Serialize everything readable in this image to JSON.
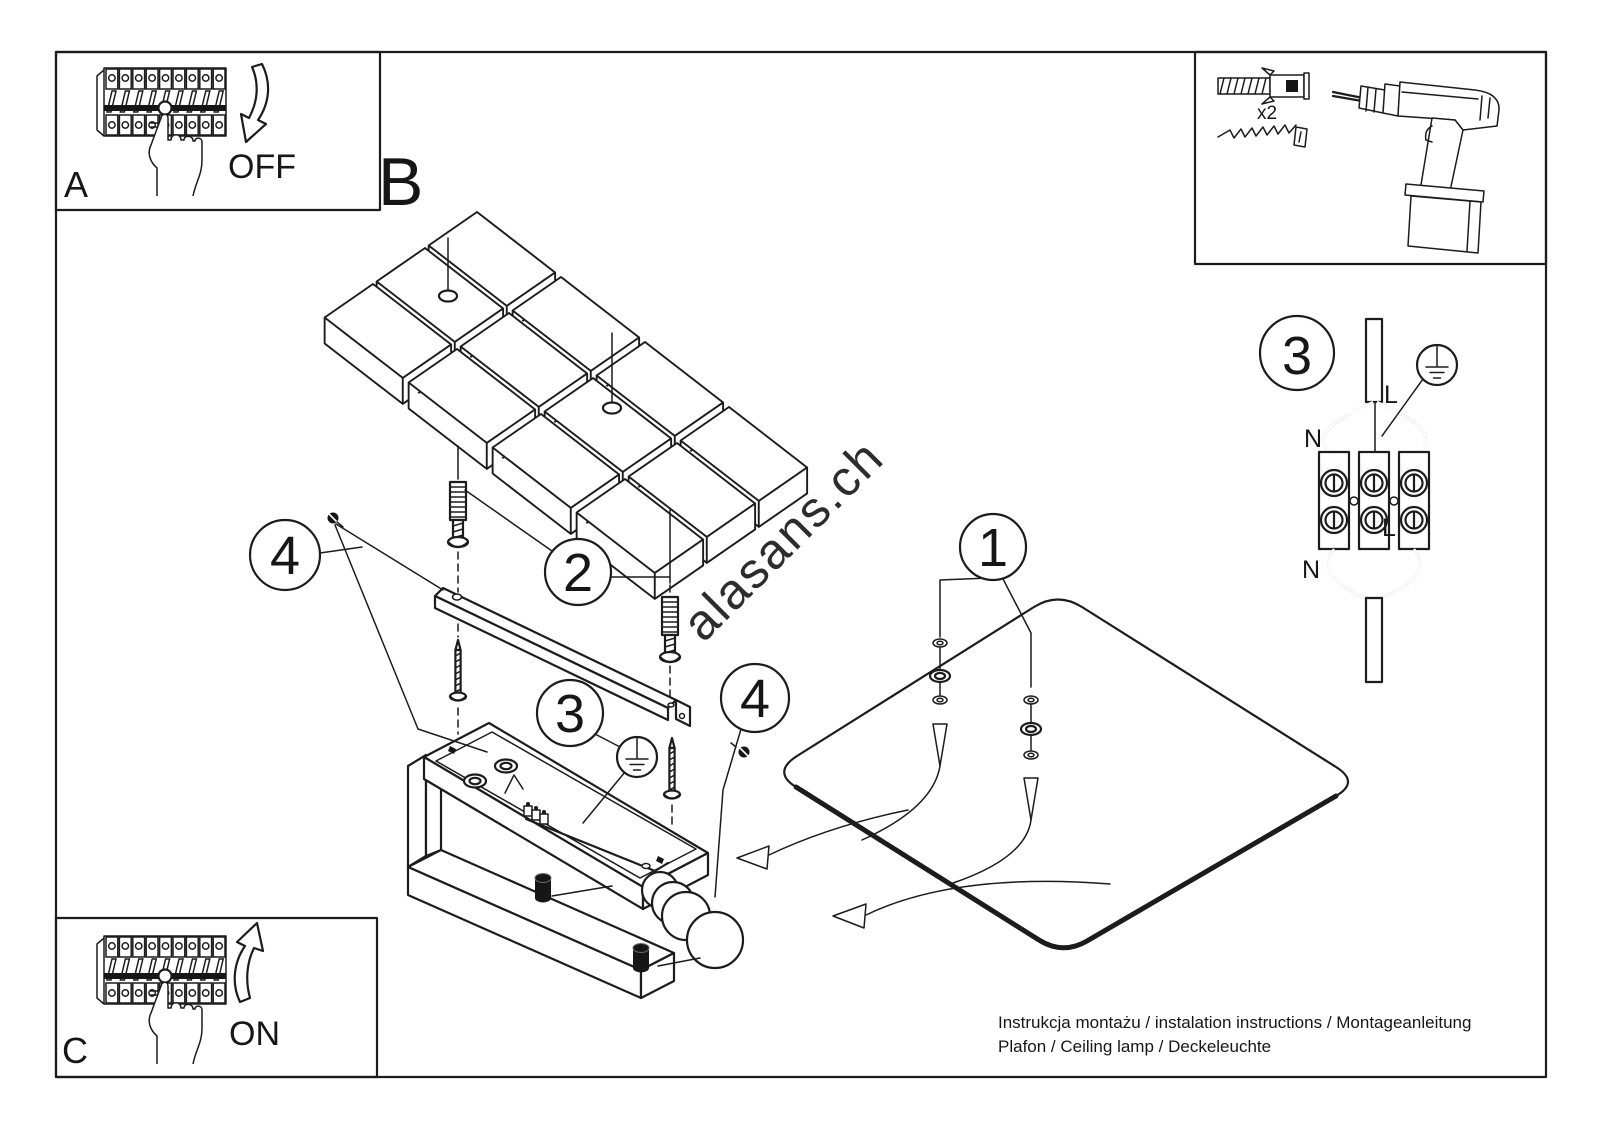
{
  "figure": {
    "watermark": "alasans.ch",
    "footer_line1": "Instrukcja montażu / instalation instructions / Montageanleitung",
    "footer_line2": "Plafon / Ceiling lamp / Deckeleuchte"
  },
  "steps": {
    "a_label": "A",
    "a_action": "OFF",
    "b_label": "B",
    "c_label": "C",
    "c_action": "ON"
  },
  "tools": {
    "anchor_qty": "x2"
  },
  "callouts": {
    "panel": "1",
    "anchors": "2",
    "ground": "3",
    "screws_left": "4",
    "screws_right": "4",
    "wiring_detail": "3"
  },
  "wiring": {
    "l_top": "L",
    "n_top": "N",
    "l_mid": "L",
    "n_bottom": "N"
  },
  "colors": {
    "line": "#1c1c1c",
    "watermark": "#c9c9c9",
    "background": "#ffffff"
  }
}
